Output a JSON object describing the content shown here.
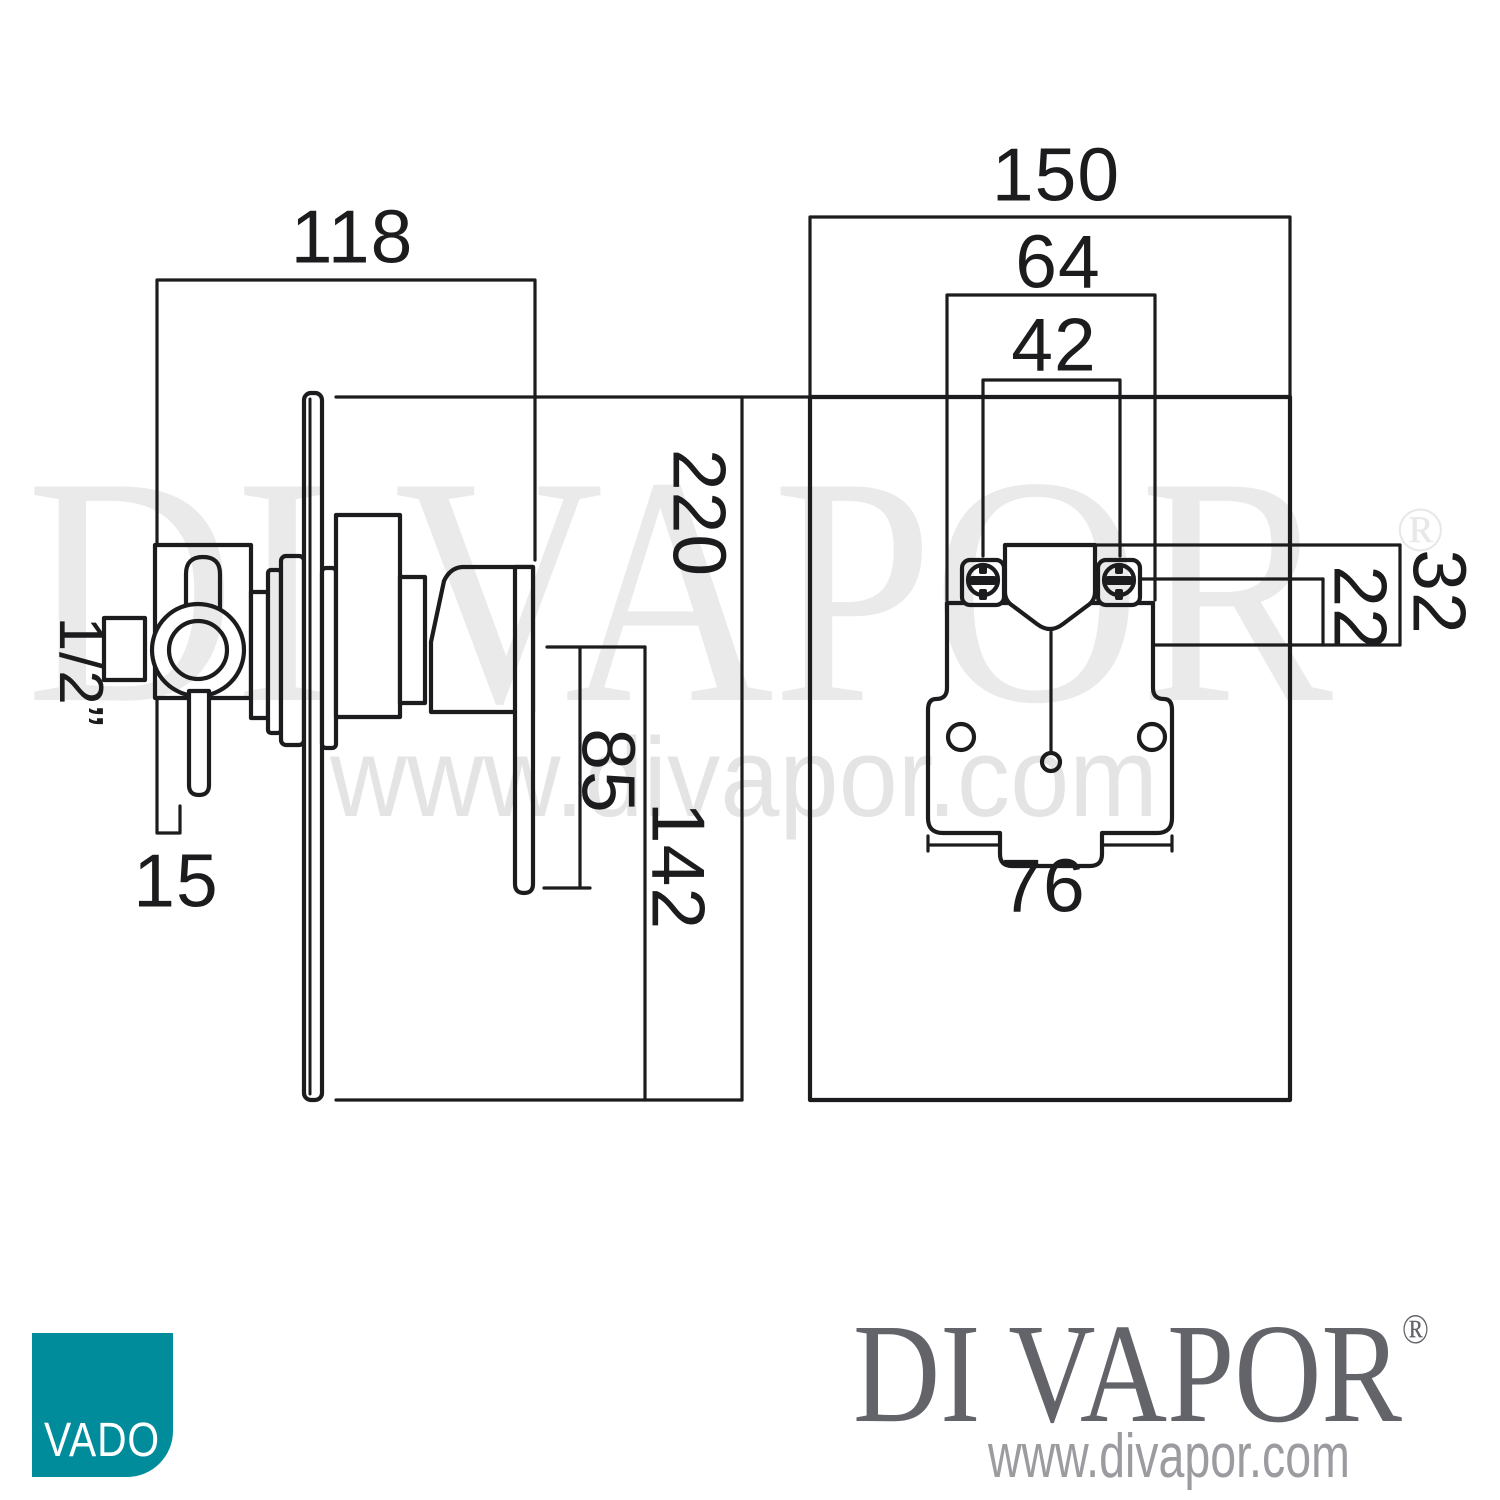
{
  "page": {
    "background": "#ffffff"
  },
  "watermark": {
    "brand": "DI VAPOR",
    "registered": "®",
    "url": "www.divapor.com",
    "color": "#e8e8ea"
  },
  "drawing": {
    "line_color": "#1c1c1e",
    "left_view": {
      "name": "shower valve side elevation",
      "dims": {
        "width": "118",
        "height": "220",
        "handle_length": "85",
        "handle_drop": "142",
        "lever_offset": "15",
        "inlet_size": "1/2”"
      }
    },
    "right_view": {
      "name": "shower valve front elevation",
      "dims": {
        "width": "150",
        "ports_span": "64",
        "ports_centres": "42",
        "depth_outer": "32",
        "depth_inner": "22",
        "bracket_width": "76"
      }
    }
  },
  "footer": {
    "vado": {
      "label": "VADO",
      "tile_color": "#008c9b",
      "text_color": "#ffffff"
    },
    "divapor": {
      "brand": "DI VAPOR",
      "registered": "®",
      "url": "www.divapor.com",
      "brand_color": "#63636a",
      "url_color": "#9b9ba0"
    }
  }
}
